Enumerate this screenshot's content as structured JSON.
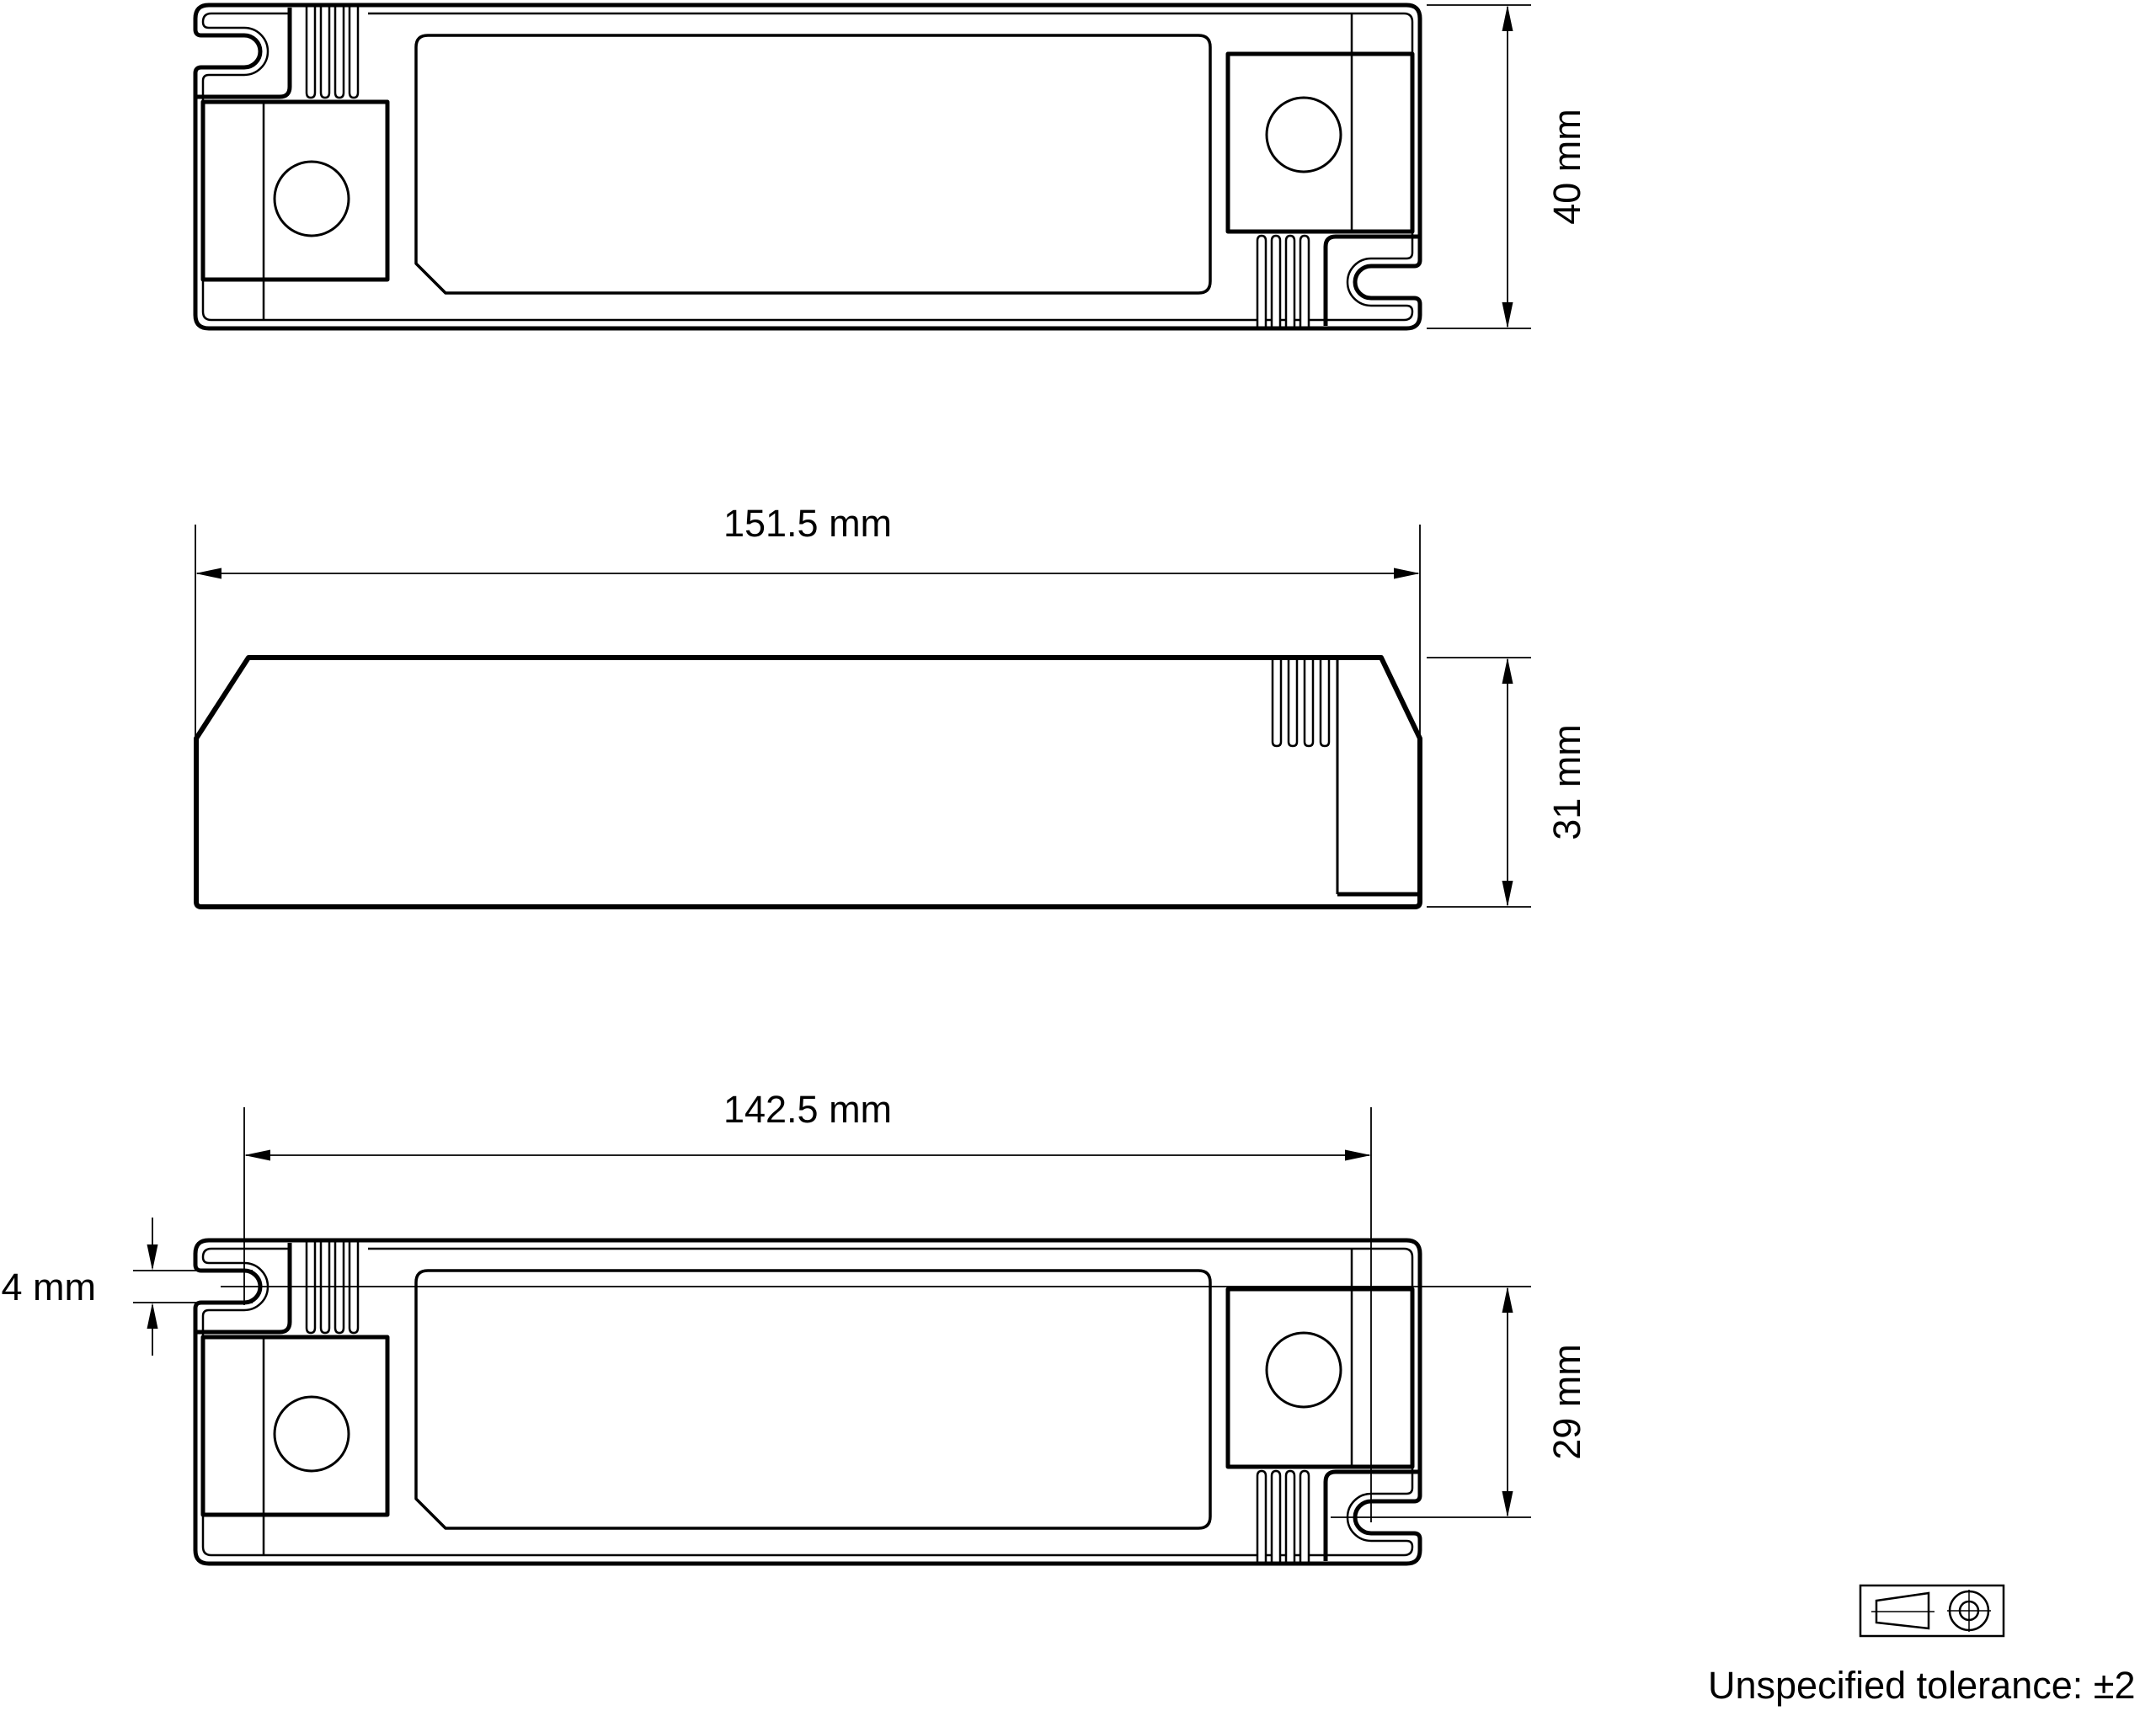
{
  "page": {
    "background": "#ffffff",
    "line_color": "#000000"
  },
  "views": {
    "top": {
      "label": "top view",
      "height_dim": "40 mm"
    },
    "side": {
      "label": "side view",
      "length_dim": "151.5 mm",
      "height_dim": "31 mm"
    },
    "bottom": {
      "label": "bottom view",
      "hole_spacing_dim": "142.5 mm",
      "slot_width_dim": "4 mm",
      "hole_offset_dim": "29 mm"
    }
  },
  "note": "Unspecified tolerance: ±2",
  "symbols": {
    "projection": "first-angle-projection"
  }
}
